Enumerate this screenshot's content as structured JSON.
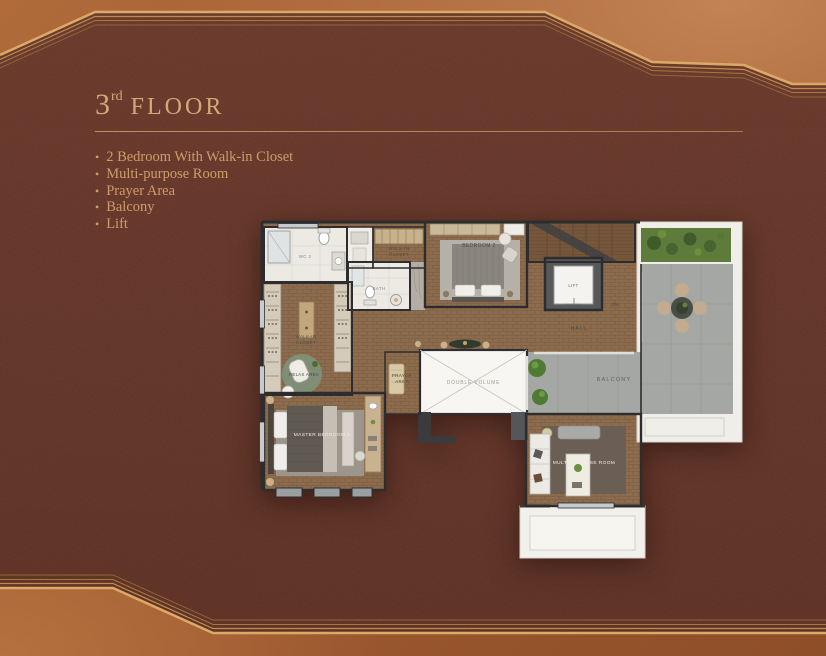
{
  "slide": {
    "title": {
      "number": "3",
      "ordinal": "rd",
      "word": "FLOOR"
    },
    "bullet_char": "•",
    "features": [
      "2 Bedroom With Walk-in Closet",
      "Multi-purpose Room",
      "Prayer Area",
      "Balcony",
      "Lift"
    ]
  },
  "plan": {
    "labels": {
      "wc2": "WC 2",
      "walkin_top_line1": "WALK-IN",
      "walkin_top_line2": "CLOSET",
      "bath": "BATH",
      "bedroom2": "BEDROOM 2",
      "lift": "LIFT",
      "dn": "DN",
      "hall": "HALL",
      "walkin_left_line1": "WALK-IN",
      "walkin_left_line2": "CLOSET",
      "relax": "RELAX AREA",
      "prayer_line1": "PRAYER",
      "prayer_line2": "AREA",
      "double_volume": "DOUBLE VOLUME",
      "balcony": "BALCONY",
      "master_bedroom": "MASTER BEDROOM 2",
      "multipurpose": "MULTI-PURPOSE ROOM"
    }
  },
  "colors": {
    "accent_gold": "#d2a06a",
    "panel_dark": "#5f3327",
    "copper": "#b06b3b",
    "wood_floor": "#8d6c4e",
    "balcony_gray": "#a4a7a3",
    "planter_green": "#5d7c3c",
    "plan_white": "#eceae3",
    "wall_dark": "#2d2d2f"
  }
}
